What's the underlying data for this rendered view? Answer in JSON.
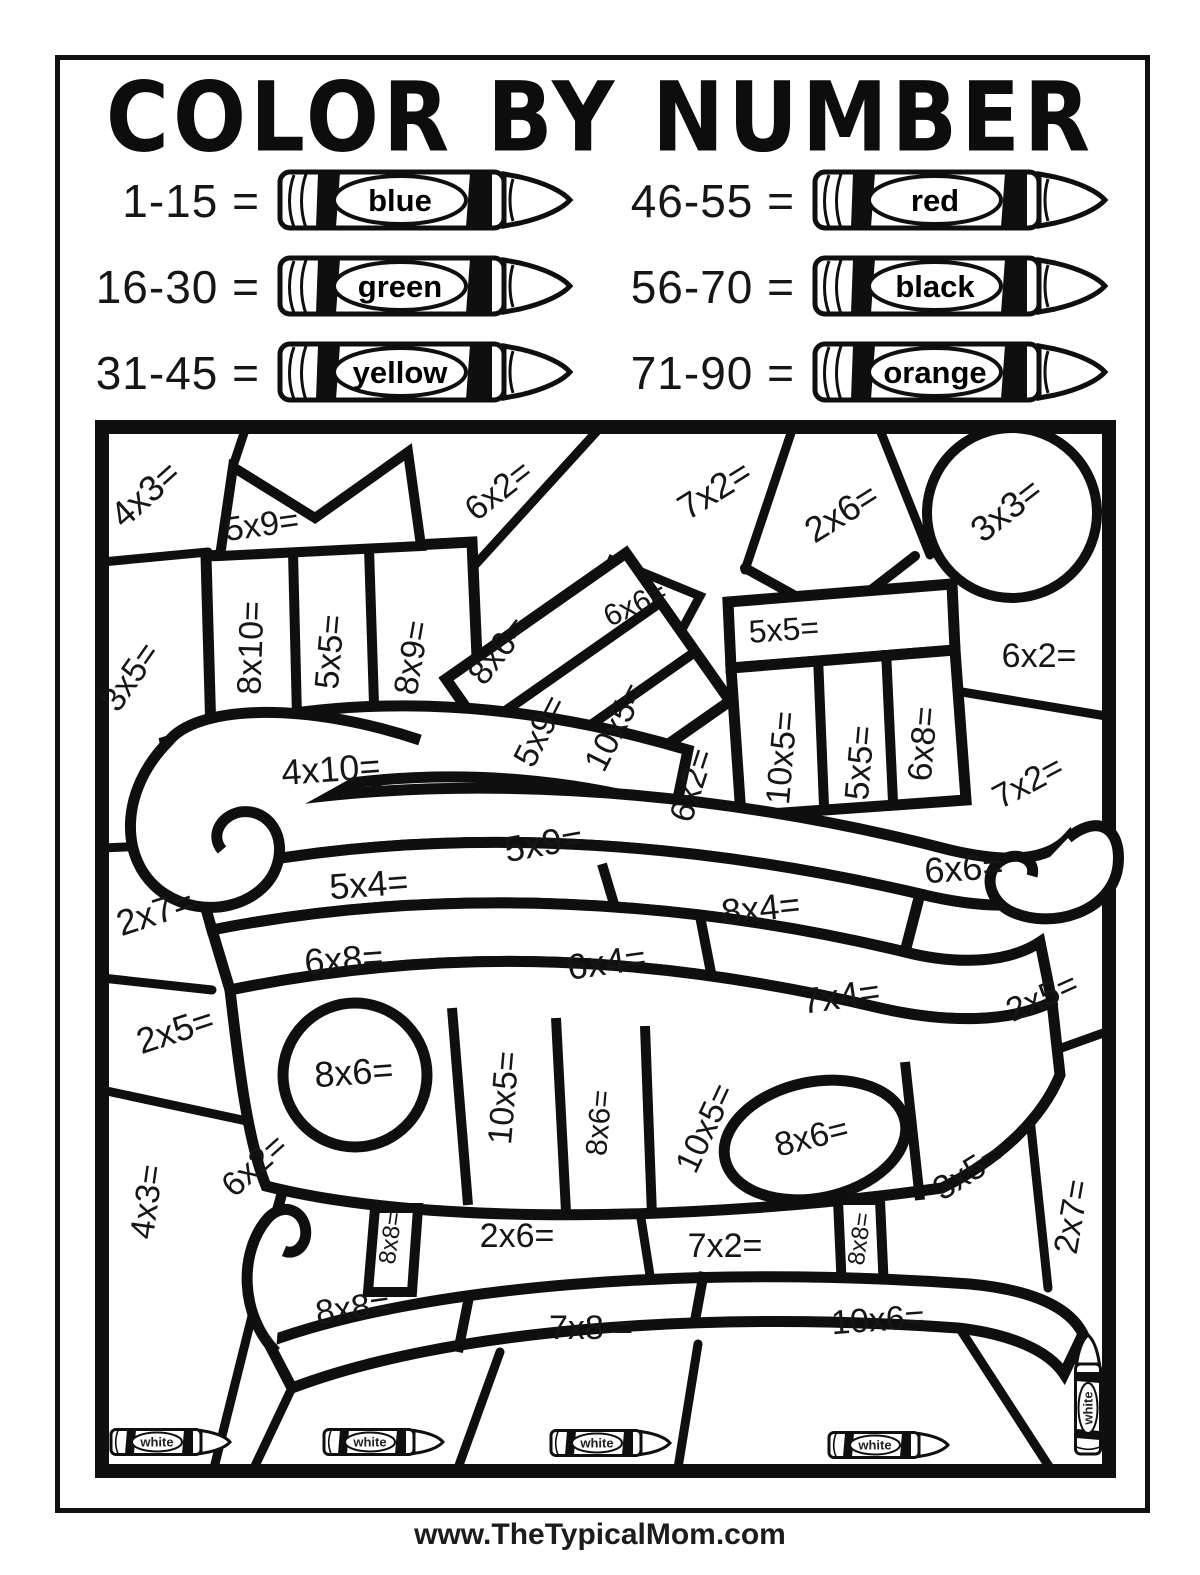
{
  "page": {
    "title": "COLOR BY NUMBER",
    "footer": "www.TheTypicalMom.com"
  },
  "colors": {
    "ink": "#111111",
    "paper": "#ffffff"
  },
  "legend": {
    "left": [
      {
        "range": "1-15 =",
        "color": "blue"
      },
      {
        "range": "16-30 =",
        "color": "green"
      },
      {
        "range": "31-45 =",
        "color": "yellow"
      }
    ],
    "right": [
      {
        "range": "46-55 =",
        "color": "red"
      },
      {
        "range": "56-70 =",
        "color": "black"
      },
      {
        "range": "71-90 =",
        "color": "orange"
      }
    ]
  },
  "coloring": {
    "labels": [
      {
        "t": "4x3=",
        "x": 147,
        "y": 496,
        "r": -42,
        "s": 36
      },
      {
        "t": "5x9=",
        "x": 262,
        "y": 527,
        "r": -8,
        "s": 34
      },
      {
        "t": "6x2=",
        "x": 500,
        "y": 492,
        "r": -38,
        "s": 34
      },
      {
        "t": "7x2=",
        "x": 716,
        "y": 492,
        "r": -32,
        "s": 36
      },
      {
        "t": "2x6=",
        "x": 843,
        "y": 515,
        "r": -32,
        "s": 36
      },
      {
        "t": "3x3=",
        "x": 1008,
        "y": 512,
        "r": -38,
        "s": 36
      },
      {
        "t": "3x5=",
        "x": 132,
        "y": 678,
        "r": -55,
        "s": 34
      },
      {
        "t": "8x10=",
        "x": 253,
        "y": 648,
        "r": -88,
        "s": 34
      },
      {
        "t": "5x5=",
        "x": 332,
        "y": 652,
        "r": -85,
        "s": 34
      },
      {
        "t": "8x9=",
        "x": 414,
        "y": 658,
        "r": -80,
        "s": 34
      },
      {
        "t": "8x6=",
        "x": 500,
        "y": 652,
        "r": -52,
        "s": 34
      },
      {
        "t": "6x6=",
        "x": 636,
        "y": 606,
        "r": -25,
        "s": 30
      },
      {
        "t": "5x9=",
        "x": 542,
        "y": 732,
        "r": -63,
        "s": 34
      },
      {
        "t": "10x5=",
        "x": 617,
        "y": 728,
        "r": -63,
        "s": 34
      },
      {
        "t": "6x2=",
        "x": 694,
        "y": 786,
        "r": -72,
        "s": 34
      },
      {
        "t": "5x5=",
        "x": 784,
        "y": 632,
        "r": -4,
        "s": 32
      },
      {
        "t": "10x5=",
        "x": 784,
        "y": 758,
        "r": -85,
        "s": 34
      },
      {
        "t": "5x5=",
        "x": 862,
        "y": 763,
        "r": -85,
        "s": 34
      },
      {
        "t": "6x8=",
        "x": 925,
        "y": 744,
        "r": -85,
        "s": 34
      },
      {
        "t": "6x2=",
        "x": 1039,
        "y": 658,
        "r": 0,
        "s": 34
      },
      {
        "t": "7x2=",
        "x": 1029,
        "y": 784,
        "r": -28,
        "s": 34
      },
      {
        "t": "4x10=",
        "x": 331,
        "y": 772,
        "r": -4,
        "s": 36
      },
      {
        "t": "5x9=",
        "x": 544,
        "y": 846,
        "r": -10,
        "s": 36
      },
      {
        "t": "5x4=",
        "x": 369,
        "y": 887,
        "r": -4,
        "s": 36
      },
      {
        "t": "2x7=",
        "x": 156,
        "y": 915,
        "r": -18,
        "s": 36
      },
      {
        "t": "6x8=",
        "x": 344,
        "y": 962,
        "r": -4,
        "s": 36
      },
      {
        "t": "6x4=",
        "x": 607,
        "y": 965,
        "r": -8,
        "s": 36
      },
      {
        "t": "8x4=",
        "x": 761,
        "y": 911,
        "r": -6,
        "s": 36
      },
      {
        "t": "6x6=",
        "x": 964,
        "y": 871,
        "r": -4,
        "s": 36
      },
      {
        "t": "7x4=",
        "x": 841,
        "y": 999,
        "r": -8,
        "s": 36
      },
      {
        "t": "2x5=",
        "x": 1043,
        "y": 999,
        "r": -24,
        "s": 34
      },
      {
        "t": "2x5=",
        "x": 176,
        "y": 1033,
        "r": -18,
        "s": 36
      },
      {
        "t": "8x6=",
        "x": 354,
        "y": 1075,
        "r": -4,
        "s": 36
      },
      {
        "t": "10x5=",
        "x": 506,
        "y": 1098,
        "r": -85,
        "s": 34
      },
      {
        "t": "8x6=",
        "x": 601,
        "y": 1123,
        "r": -85,
        "s": 30
      },
      {
        "t": "10x5=",
        "x": 707,
        "y": 1129,
        "r": -65,
        "s": 34
      },
      {
        "t": "8x6=",
        "x": 812,
        "y": 1139,
        "r": -14,
        "s": 34
      },
      {
        "t": "3x5=",
        "x": 969,
        "y": 1174,
        "r": -32,
        "s": 34
      },
      {
        "t": "2x7=",
        "x": 1074,
        "y": 1217,
        "r": -80,
        "s": 34
      },
      {
        "t": "4x3=",
        "x": 149,
        "y": 1202,
        "r": -82,
        "s": 34
      },
      {
        "t": "6x2=",
        "x": 256,
        "y": 1167,
        "r": -42,
        "s": 34
      },
      {
        "t": "8x8=",
        "x": 392,
        "y": 1238,
        "r": -82,
        "s": 24
      },
      {
        "t": "2x6=",
        "x": 517,
        "y": 1238,
        "r": 0,
        "s": 34
      },
      {
        "t": "7x2=",
        "x": 725,
        "y": 1248,
        "r": 0,
        "s": 34
      },
      {
        "t": "8x8=",
        "x": 861,
        "y": 1239,
        "r": -82,
        "s": 24
      },
      {
        "t": "8x8=",
        "x": 353,
        "y": 1310,
        "r": -8,
        "s": 34
      },
      {
        "t": "7x8 =",
        "x": 591,
        "y": 1330,
        "r": 0,
        "s": 34
      },
      {
        "t": "10x6=",
        "x": 878,
        "y": 1322,
        "r": -4,
        "s": 34
      }
    ],
    "white_crayons": {
      "label": "white",
      "positions": [
        {
          "x": 170,
          "y": 1442,
          "r": 0
        },
        {
          "x": 383,
          "y": 1442,
          "r": 0
        },
        {
          "x": 610,
          "y": 1443,
          "r": 0
        },
        {
          "x": 888,
          "y": 1445,
          "r": 0
        },
        {
          "x": 1088,
          "y": 1395,
          "r": -90
        }
      ]
    }
  }
}
